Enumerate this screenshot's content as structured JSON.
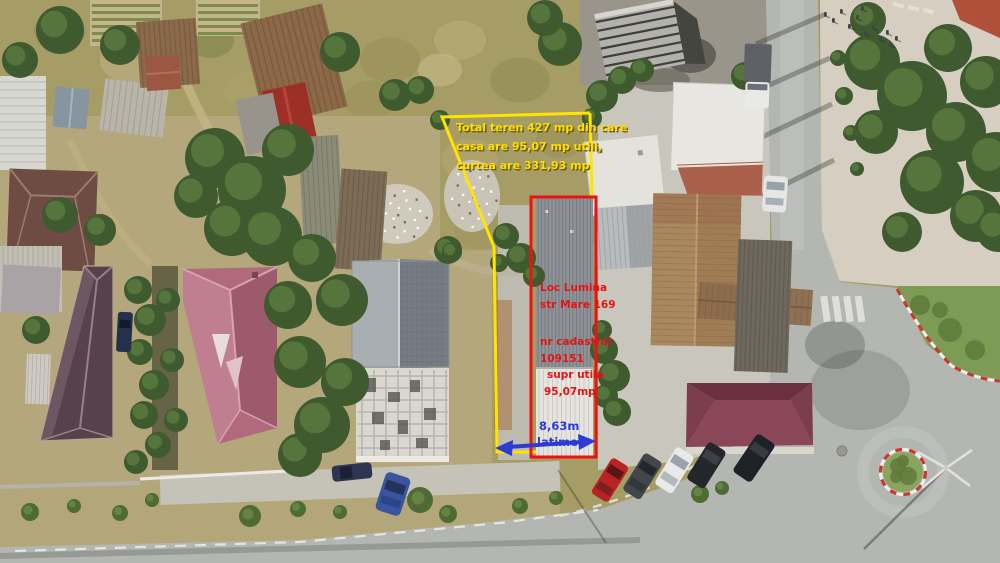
{
  "annotations": {
    "total_area_note": {
      "color": "#ffdf00",
      "lines": [
        "Total teren 427 mp din care",
        "casa are 95,07 mp utili,",
        "curtea are 331,93 mp"
      ]
    },
    "property_label": {
      "color": "#e21414",
      "lines": [
        "Loc Lumina",
        "str Mare 169",
        "nr cadastral",
        "109151",
        "supr utila",
        "95,07mp"
      ]
    },
    "width_label": {
      "color": "#2b3bd4",
      "value": "8,63m",
      "unit_label": "latime"
    },
    "parcel_outline": {
      "color": "#ffe400"
    },
    "house_outline": {
      "color": "#ee1111"
    }
  }
}
